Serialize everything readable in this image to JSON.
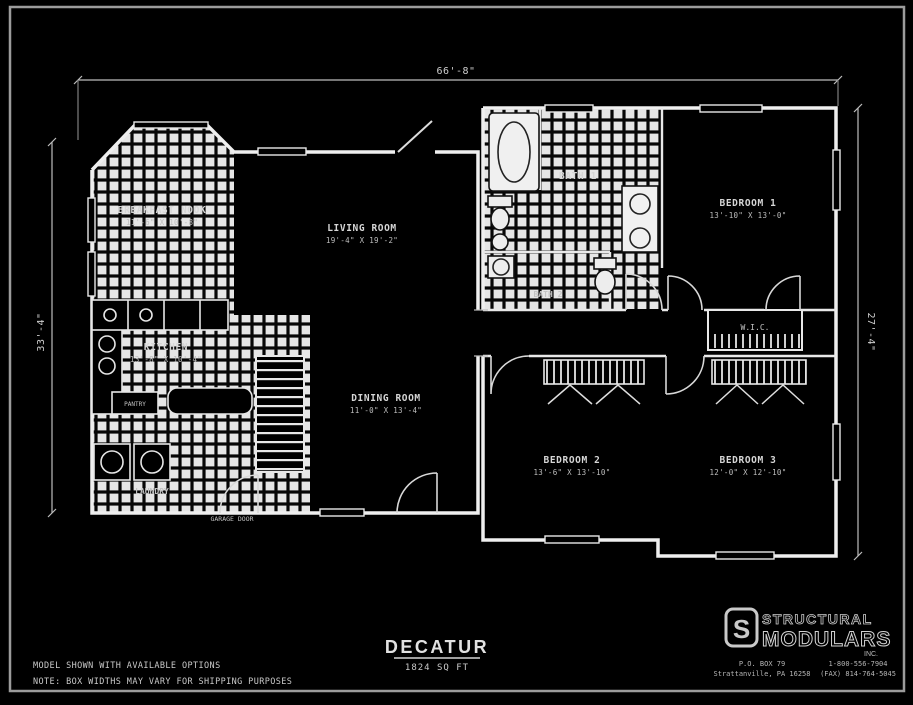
{
  "meta": {
    "background_color": "#000000",
    "line_color": "#ededed",
    "text_color": "#d6d6d6",
    "tile_color": "#e6e6e6"
  },
  "dimensions": {
    "top": "66'-8\"",
    "left": "33'-4\"",
    "right": "27'-4\""
  },
  "rooms": {
    "breakfast_nook": {
      "label": "BREAKFAST NOOK",
      "size": "11'-6\" X 10'-8\""
    },
    "living_room": {
      "label": "LIVING ROOM",
      "size": "19'-4\" X 19'-2\""
    },
    "kitchen": {
      "label": "KITCHEN",
      "size": "13'-8\" X 10'-4\""
    },
    "dining_room": {
      "label": "DINING ROOM",
      "size": "11'-0\" X 13'-4\""
    },
    "bath1": {
      "label": "BATH 1"
    },
    "bath2": {
      "label": "BATH 2"
    },
    "bedroom1": {
      "label": "BEDROOM 1",
      "size": "13'-10\" X 13'-0\""
    },
    "bedroom2": {
      "label": "BEDROOM 2",
      "size": "13'-6\" X 13'-10\""
    },
    "bedroom3": {
      "label": "BEDROOM 3",
      "size": "12'-0\" X 12'-10\""
    },
    "wic": {
      "label": "W.I.C."
    },
    "laundry": {
      "label": "LAUNDRY"
    },
    "pantry": {
      "label": "PANTRY"
    },
    "garage_door": {
      "label": "GARAGE DOOR"
    }
  },
  "title_block": {
    "model_name": "DECATUR",
    "area": "1824 SQ FT",
    "note1": "MODEL SHOWN WITH AVAILABLE OPTIONS",
    "note2": "NOTE: BOX WIDTHS MAY VARY FOR SHIPPING PURPOSES"
  },
  "logo": {
    "monogram": "S",
    "line1": "STRUCTURAL",
    "line2": "MODULARS",
    "suffix": "INC."
  },
  "contact": {
    "address_line1": "P.O. BOX 79",
    "address_line2": "Strattanville, PA 16258",
    "phone_line1": "1-800-556-7904",
    "phone_line2": "(FAX) 814-764-5045"
  }
}
